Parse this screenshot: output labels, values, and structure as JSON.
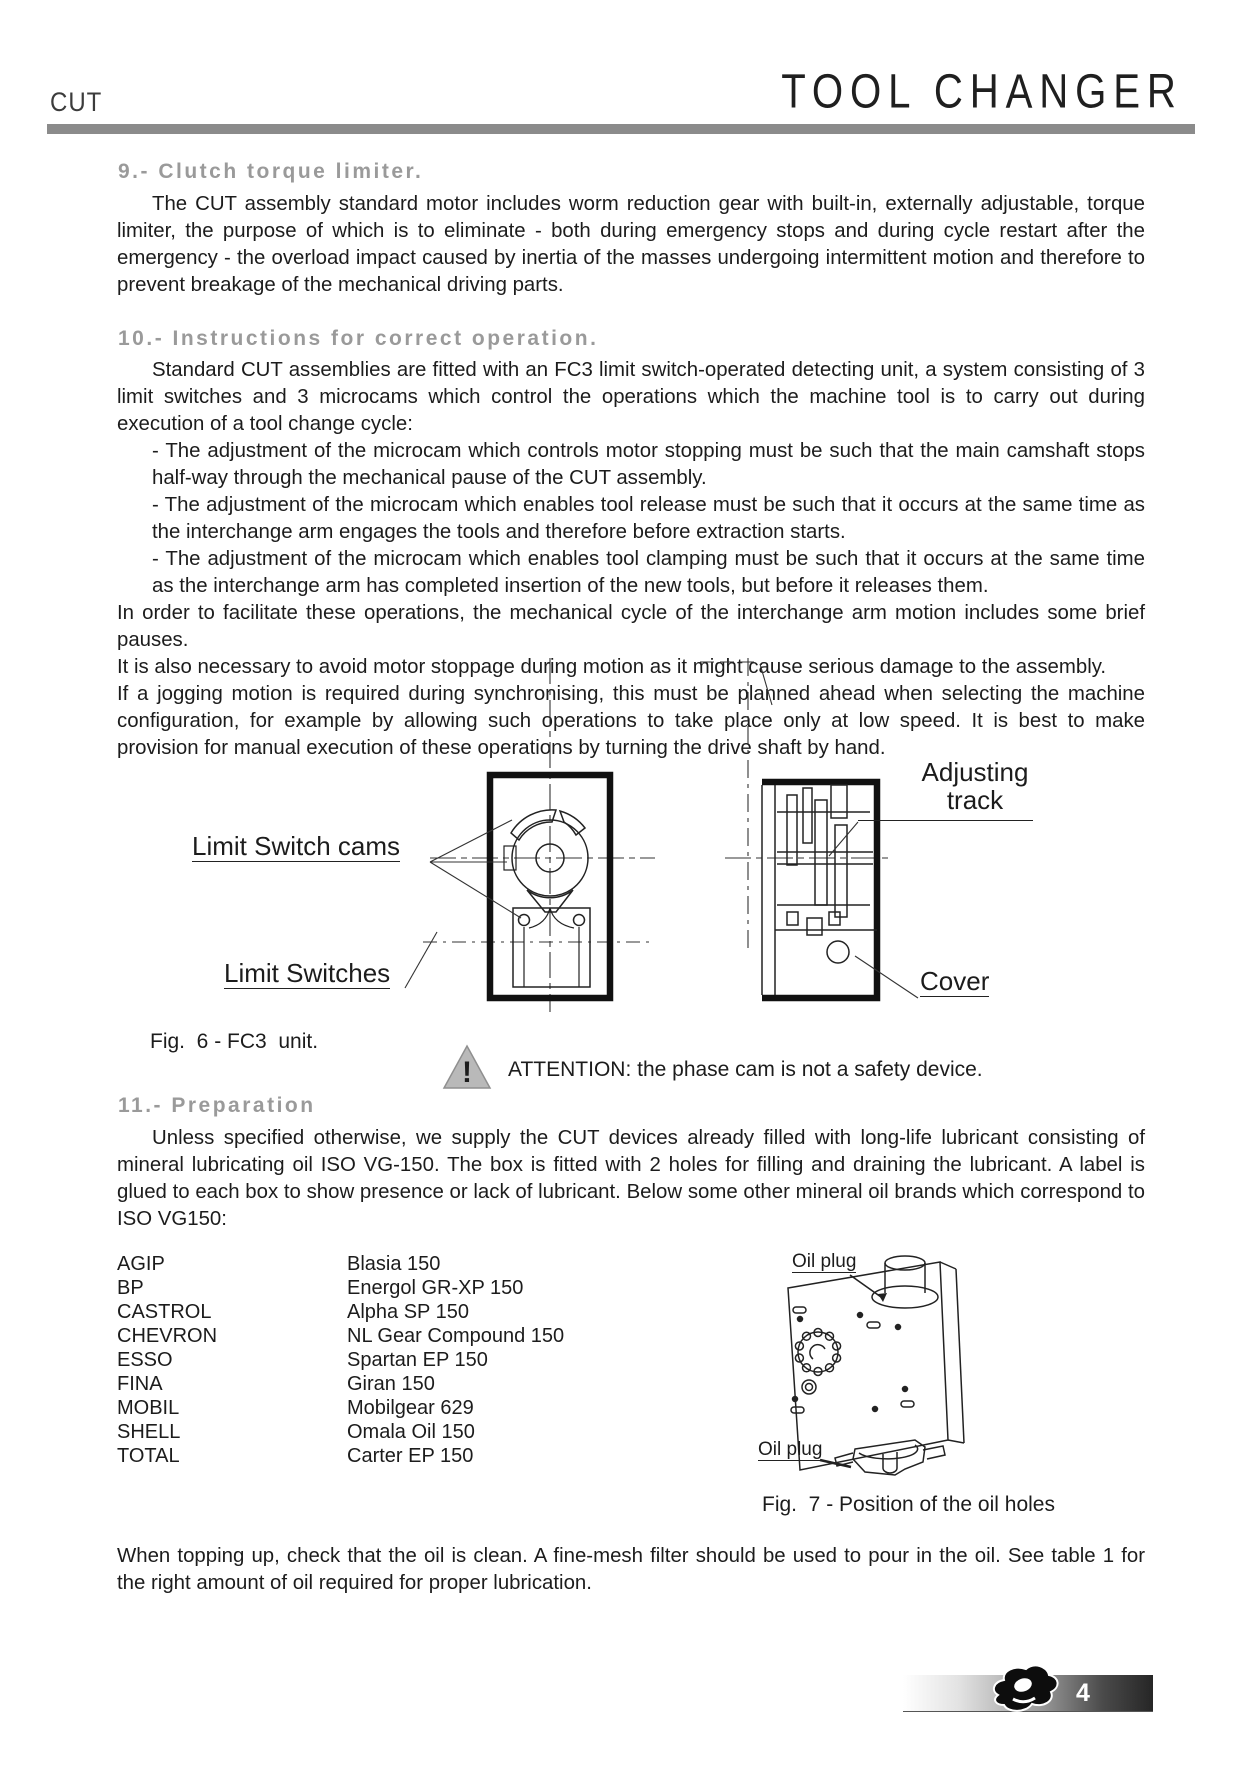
{
  "header": {
    "product": "CUT",
    "title": "TOOL CHANGER"
  },
  "sections": {
    "s9": {
      "heading": "9.- Clutch torque limiter.",
      "para": "The CUT assembly standard motor includes worm reduction gear with built-in, externally adjustable, torque limiter, the purpose of which is to eliminate - both during emergency stops and during cycle restart after the emergency - the overload impact caused by inertia of the masses undergoing intermittent motion and therefore to prevent breakage of the mechanical driving parts."
    },
    "s10": {
      "heading": "10.- Instructions for correct operation.",
      "intro": "Standard CUT assemblies are fitted with an FC3 limit switch-operated detecting unit, a system consisting of 3 limit switches and 3 microcams which control the operations which the machine tool is to carry out during execution of a tool change cycle:",
      "bullets": [
        "- The adjustment of the microcam which controls motor stopping must be such that the main camshaft stops half-way through the mechanical pause of the CUT assembly.",
        "- The adjustment of the microcam which enables tool release must be such that it occurs at the same time as the interchange arm engages the tools and therefore before extraction starts.",
        "- The adjustment of the microcam which enables tool clamping must be such that it occurs at the same time as the interchange arm has completed insertion of the new tools, but before it releases them."
      ],
      "paras": [
        "In order to facilitate these operations, the mechanical cycle of the interchange arm motion includes some brief pauses.",
        "It is also necessary to avoid motor stoppage during motion as it might cause serious damage to the assembly.",
        "If a jogging motion is required during synchronising, this must be planned ahead when selecting the machine configuration, for example by allowing such operations to take place only at low speed. It is best to make provision for manual execution of these operations by turning the drive shaft by hand."
      ]
    },
    "s11": {
      "heading": "11.- Preparation",
      "para": "Unless specified otherwise, we supply the CUT devices already filled with long-life lubricant consisting of mineral lubricating oil ISO VG-150. The box is fitted with 2 holes for filling and draining the lubricant. A label is glued to each box to show presence or lack of lubricant. Below some other mineral oil brands which correspond to ISO VG150:"
    }
  },
  "fig6": {
    "labels": {
      "cams": "Limit Switch cams",
      "switches": "Limit Switches",
      "adjusting_line1": "Adjusting",
      "adjusting_line2": "track",
      "cover": "Cover"
    },
    "caption": "Fig.  6 - FC3  unit."
  },
  "warning": {
    "icon_glyph": "!",
    "text": "ATTENTION: the phase cam is not a safety device."
  },
  "oil_table": {
    "rows": [
      {
        "brand": "AGIP",
        "product": "Blasia 150"
      },
      {
        "brand": "BP",
        "product": "Energol GR-XP 150"
      },
      {
        "brand": "CASTROL",
        "product": "Alpha SP 150"
      },
      {
        "brand": "CHEVRON",
        "product": "NL Gear Compound 150"
      },
      {
        "brand": "ESSO",
        "product": "Spartan EP 150"
      },
      {
        "brand": "FINA",
        "product": "Giran 150"
      },
      {
        "brand": "MOBIL",
        "product": "Mobilgear 629"
      },
      {
        "brand": "SHELL",
        "product": "Omala Oil 150"
      },
      {
        "brand": "TOTAL",
        "product": "Carter EP 150"
      }
    ]
  },
  "fig7": {
    "labels": {
      "top": "Oil plug",
      "bottom": "Oil plug"
    },
    "caption": "Fig.  7 - Position of the oil holes"
  },
  "closing_para": "When topping up, check that the oil is clean. A fine-mesh filter should be used to pour in the oil. See table 1 for the right amount of oil required for proper lubrication.",
  "footer": {
    "page_number": "4"
  },
  "colors": {
    "rule_gray": "#8b8b8b",
    "heading_gray": "#9a9a9a",
    "warning_fill": "#b9b9b9",
    "footer_dark": "#262626",
    "text": "#1c1c1c"
  }
}
